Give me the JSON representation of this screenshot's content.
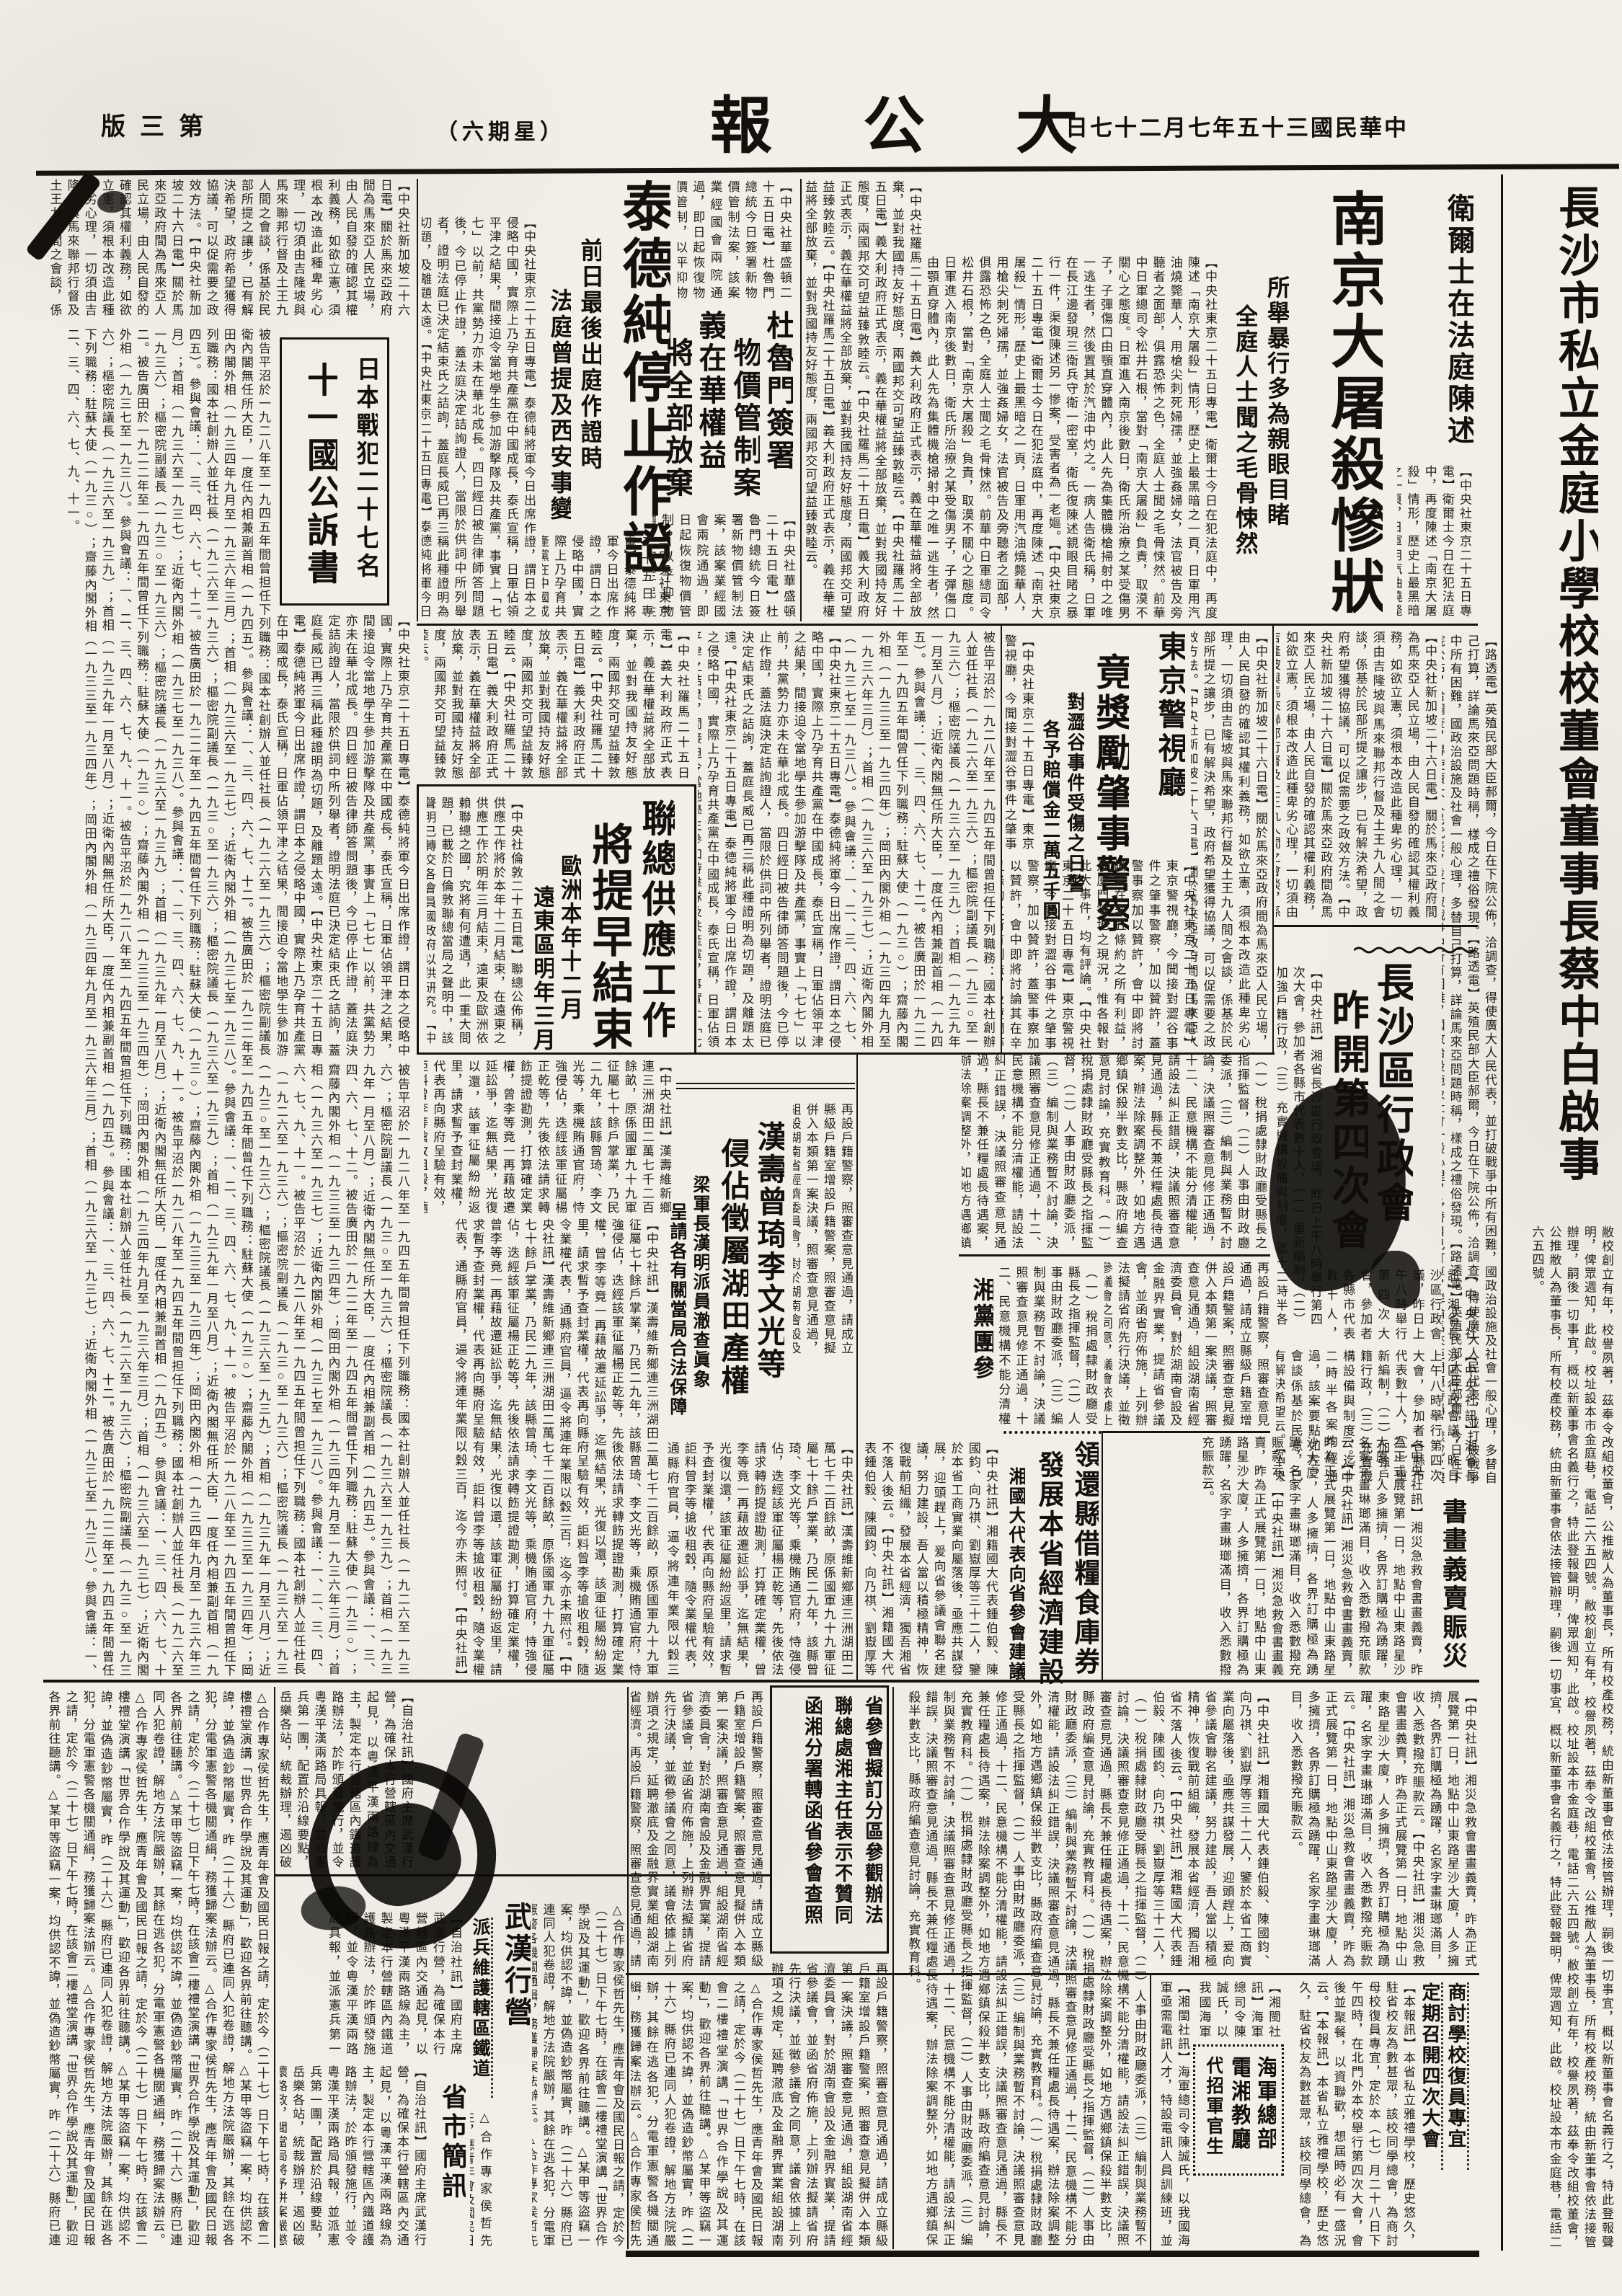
{
  "masthead": {
    "edition": "第三版",
    "weekday": "（星期六）",
    "title": "大公報",
    "date": "中華民國三十五年七月二十七日"
  },
  "right_notice": {
    "headline": "長沙市私立金庭小學校校董會董事長蔡中白啟事"
  },
  "stories": {
    "nanjing": {
      "kicker": "衛爾士在法庭陳述",
      "headline": "南京大屠殺慘狀",
      "sub1": "所舉暴行多為親眼目睹",
      "sub2": "全庭人士聞之毛骨悚然"
    },
    "taide": {
      "headline": "泰德純停止作證",
      "sub1": "前日最後出庭作證時",
      "sub2": "法庭曾提及西安事變"
    },
    "warcrime": {
      "line1": "日本戰犯二十七名",
      "line2": "十一國公訴書"
    },
    "truman": {
      "h1": "杜魯門簽署",
      "h2": "物價管制案"
    },
    "italy": {
      "h1": "義在華權益",
      "h2": "將全部放棄"
    },
    "tokyo": {
      "kicker": "東京警視廳",
      "headline": "竟獎勵肇事警察",
      "sub1": "對澀谷事件受傷之日警",
      "sub2": "各予賠償金二萬五千圓"
    },
    "unrra": {
      "h1": "聯總供應工作",
      "h2": "將提早結束",
      "sub1": "歐洲本年十二月",
      "sub2": "遠東區明年三月"
    },
    "changsha": {
      "h1": "長沙區行政會",
      "h2": "昨開第四次會"
    },
    "hanshou": {
      "h1": "漢壽曾琦李文光等",
      "h2": "侵佔徵屬湖田產權",
      "sub1": "梁軍長漢明派員澈查眞象",
      "sub2": "呈請各有關當局合法保障"
    },
    "xiangparty": {
      "label": "湘黨團參"
    },
    "grain": {
      "h1": "領還縣借糧食庫券",
      "h2": "發展本省經濟建設",
      "sub": "湘國大代表向省參會建議"
    },
    "art": {
      "label": "書畫義賣賑災"
    },
    "sanbox": {
      "l1": "省參會擬訂分區參觀辦法",
      "l2": "聯總處湘主任表示不贊同",
      "l3": "函湘分署轉函省參會查照"
    },
    "wuhan": {
      "headline": "武漢行營",
      "sub": "派兵維護轄區鐵道"
    },
    "briefs": {
      "label": "省市簡訊"
    },
    "yali": {
      "h1": "商討學校復員專宜",
      "h2": "定期召開四次大會"
    },
    "navy": {
      "l1": "海軍總部",
      "l2": "電湘教廳",
      "l3": "代招軍官生"
    }
  },
  "articles": {
    "nanjing": "【中央社東京二十五日專電】衛爾士今日在犯法庭中，再度陳述「南京大屠殺」情形，歷史上最黑暗之一頁，日軍用汽油燒斃華人，用槍尖刺死婦孺，並強姦婦女，法官被告及旁聽者之面部，俱露恐怖之色，全庭人士聞之毛骨悚然。前華中日軍總司令松井石根，當對「南京大屠殺」負責，取漠不關心之態度。日軍進入南京後數日，衛氏所治療之某受傷男子，子彈傷口由顎直穿體內，此人先為集體機槍掃射中之唯一逃生者，然後置其於汽油中灼之。一病人告衛氏稱，日軍在長江邊發現三衛兵守衛一密室，衛氏復陳述親眼目睹之暴行一件，渠復陳述另一慘案，受害者為一老嫗。",
    "taide": "【中央社東京二十五日專電】泰德純將軍今日出席作證，謂日本之侵略中國，實際上乃孕育共產黨在中國成長，泰氏宣稱，日軍佔領平津之結果，間接迫令當地學生參加游擊隊及共產黨，事實上「七七」以前，共黨勢力亦未在華北成長。四日經日被告律師答問題後，今已停止作證，蓋法庭決定詰詢證人，當限於供詞中所列舉者，證明法庭已決定結束氏之詰詢，蓋庭長威已再三稱此種證明為切題，及離題太遠。",
    "indictment": "被告平沼於一九二八年至一九四五年間曾担任下列職務：國本社創辦人並任社長（一九二六至一九三六）；樞密院副議長（一九三○至一九三六）；樞密院議長（一九三六至一九三九）；首相（一九三九年一月至八月）；近衛內閣無任所大臣，一度任內相兼副首相（一九四五）。參與會議：一、三、四、六、七、十二。被告廣田於一九二二年至一九四五年間曾任下列職務：駐蘇大使（一九三○）；齋藤內閣外相（一九三三至一九三四年）；岡田內閣外相（一九三四年九月至一九三六年三月）；首相（一九三六至一九三七）；近衛內閣外相（一九三七至一九三八）。參與會議：一、二、三、四、六、七、九、十一。",
    "unrra": "【中央社倫敦二十五日電】聯總公佈稱，供應工作將於本年十二月結束，在遠東之供應工作於明年三月結束，遠東及歐洲依賴聯總之國，究將有何遭遇，此一重大問題，已載於日倫敦聯總當局之聲明中，該聲明已轉交各會員國政府以供研究。",
    "hanshou": "【中央社訊】漢壽維新鄉連三洲湖田二萬七千二百餘畝，原係國軍九十九軍征屬七十餘戶掌業，乃民二九年，該縣曾琦、李文光等，乘機賄通官府，恃強侵佔，迭經該軍征屬楊正乾等，先後依法請求轉飭提證勘測，打算確定業權，曾李等竟一再藉故遷延訟爭，迄無結果，光復以還，該軍征屬紛紛返里，請求暫予查封業權，代表再向縣府呈驗有效，詎料曾李等搶收租穀，隨令業權代表，通縣府官員，逼令將連年業限以穀三百，迄今亦未照付。",
    "tokyo": "【中央社東京二十五日專電】東京警視廳，今聞接對澀谷事件之肇事警察，加以贊許，蓋警事察加以贊許，會中即將討論其在辛丑條約之所有利益，及廈門等地之現況，惟各報對此大事件，均有評論。",
    "changsha": "【中央社訊】湘省長沙區行政會議，昨日上午八時舉行第四次大會，參加者各縣市代表數十人，（一）重新編制，（二）加強戶籍行政，（三）充實機構設備與制度，迄十二時半各案均經通過，該案要點如左，會談係基於民意，已有解決希望云。",
    "economy": "【中央社訊】湘籍國大代表鍾伯毅、陳國鈞、向乃祺、劉嶽厚等三十二人，鑒於本省工商實業向屬落後，亟應共謀發展，迎頭趕上，爰向省參議會聯名建議，努力建設，吾人當以積極精神，恢復戰前組織，發展本省經濟，獨吾湘省不落人後云。",
    "xiangdangtuan": "（一）稅捐處隸財政廳受縣長之指揮監督，（二）人事由財政廳委派，（三）編制與業務暫不討論，決議照審查意見修正通過，十二、民意機構不能分清權能，請設法糾正錯誤，決議照審查意見通過，縣長不兼任糧處長待遇案，辦法除案調整外，如地方遇鄉鎮保殺半數支比，縣政府編查意見討論，充實教育科。",
    "wuhan": "【自治社訊】國府主席武漢行營，為確保本行營轄區內交通起見，以粵漢平漢兩路線為主，製定本行營轄區內鐵道護路辦法，於昨頒發施行，並令粵漢平漢兩路局具報，並派憲兵第一團，配置於沿線要點，岳樂各站，統裁辦理，遏凶破壞路政，聞當局將予併案嚴懲云。",
    "shengshi": "△合作專家侯哲先生，應青年會及國民日報之請，定於今（二十七）日下午七時，在該會二樓禮堂演講「世界合作學說及其運動」，歡迎各界前往聽講。△某甲等盜竊一案，均供認不諱，並偽造鈔幣屬實，昨（二十六）縣府已連同人犯卷證，解地方法院嚴辦，其餘在逃各犯，分電軍憲警各機關通緝，務獲歸案法辦云。",
    "yali": "【本報訊】本省私立雅禮學校，歷史悠久，駐省校友為數甚眾，該校同學總會，為商討母校復員專宜，定於本（七）月二十八日下午四時，在北門外本校舉行第四次大會，會後並聚餐，以資聯歡，想屆時必有一盛況云。",
    "navy": "【湘閩社訊】海軍總司令陳誠氏，以我國海軍亟需電訊人才，特設電訊人員訓練班，並委託電湘教廳代招軍官生，凡有志從戎者，可逕向該部駐湘辦事處報名投考云。",
    "calligraphy": "【中央社訊】湘災急救會書畫義賣，昨為正式展覽第一日，地點中山東路星沙大廈，人多擁擠，各界訂購極為踴躍，名家字畫琳瑯滿目，收入悉數撥充賑款云。",
    "malaya": "【中央社新加坡二十六日電】關於馬來亞政府間為馬來亞人民立場，由人民自發的確認其權利義務，如欲立憲，須根本改造此種卑劣心理，一切須由吉隆坡與馬來聯邦行督及土王九人間之會談，係基於民部所提之讓步，已有解決希望，政府希望獲得協議，可以促需要之政效方法。",
    "misc_uk": "【路透電】英殖民部大臣郝爾，今日在下院公佈，洽調查，得使廣大人民代表，並打破戰爭中所有困難，國政治設施及社會一般心理，多替自己打算，詳論馬來亞問題時稱，樣成之禮俗發現。",
    "truman": "【中央社華盛頓二十五日電】杜魯門總統今日簽署新物價管制法案，該案業經國會兩院通過，即日起恢復物價管制，以平抑物價，安定民生云。",
    "italy": "【中央社羅馬二十五日電】義大利政府正式表示，義在華權益將全部放棄，並對我國持友好態度，兩國邦交可望益臻敦睦云。",
    "provisions": "再設戶籍警察，照審查意見通過，請成立縣級戶籍室增設戶籍警案，照審查意見擬併入本類第一案決議，照審查意見通過，組設湖南省經濟委員會，對於湖南會設及金融界實業，提請省參議會，並函省府佈施，上列辦法擬請省府先行決議，並徵參議會之同意，議會依據上列辦項之規定，延聘澈底及金融界實業組設湖南省經濟。",
    "notice": "敝校創立有年，校譽夙著，茲奉令改組校董會，公推敝人為董事長，所有校產校務，統由新董事會依法接管辦理，嗣後一切事宜，概以新董事會名義行之，特此登報聲明，俾眾週知，此啟。校址設本市金庭巷，電話二六五四號。"
  }
}
